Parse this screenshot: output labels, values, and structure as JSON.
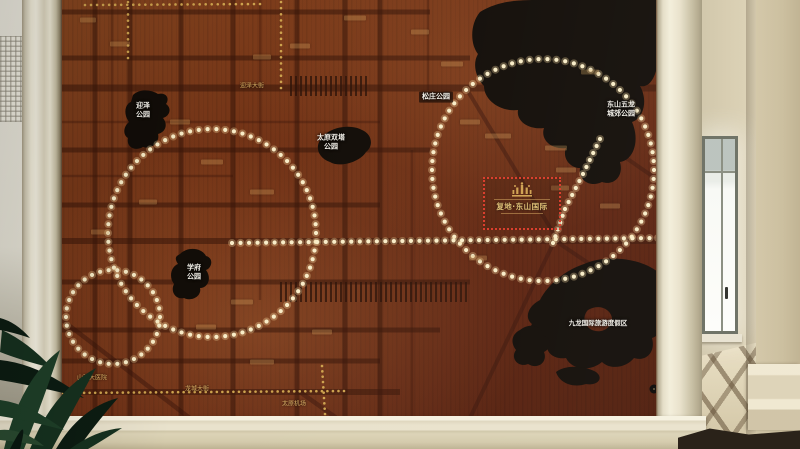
{
  "board": {
    "project_marker": {
      "label": "复地·东山国际"
    },
    "labels": [
      {
        "text": "迎泽\n公园",
        "x": 143,
        "y": 110,
        "cls": "park"
      },
      {
        "text": "太原双塔\n公园",
        "x": 331,
        "y": 142,
        "cls": "park"
      },
      {
        "text": "松庄公园",
        "x": 436,
        "y": 97,
        "cls": "park chip"
      },
      {
        "text": "东山五龙\n城郊公园",
        "x": 621,
        "y": 109,
        "cls": "park"
      },
      {
        "text": "学府\n公园",
        "x": 194,
        "y": 272,
        "cls": "park"
      },
      {
        "text": "九龙国际旅游度假区",
        "x": 598,
        "y": 323,
        "cls": "park small"
      },
      {
        "text": "迎泽大街",
        "x": 252,
        "y": 86,
        "cls": "road"
      },
      {
        "text": "龙城大街",
        "x": 197,
        "y": 389,
        "cls": "road"
      },
      {
        "text": "太原机场",
        "x": 294,
        "y": 404,
        "cls": "road"
      },
      {
        "text": "山西大医院",
        "x": 92,
        "y": 378,
        "cls": "road"
      }
    ],
    "plates": [
      [
        355,
        18,
        22
      ],
      [
        300,
        46,
        20
      ],
      [
        262,
        57,
        18
      ],
      [
        120,
        44,
        20
      ],
      [
        88,
        20,
        16
      ],
      [
        180,
        122,
        20
      ],
      [
        212,
        162,
        22
      ],
      [
        262,
        192,
        24
      ],
      [
        148,
        202,
        18
      ],
      [
        100,
        232,
        18
      ],
      [
        242,
        302,
        22
      ],
      [
        206,
        327,
        20
      ],
      [
        262,
        362,
        24
      ],
      [
        322,
        332,
        20
      ],
      [
        420,
        32,
        18
      ],
      [
        452,
        64,
        22
      ],
      [
        470,
        122,
        20
      ],
      [
        498,
        136,
        26
      ],
      [
        556,
        148,
        22
      ],
      [
        566,
        170,
        20
      ],
      [
        560,
        188,
        18
      ],
      [
        590,
        72,
        18
      ],
      [
        610,
        206,
        20
      ],
      [
        478,
        258,
        18
      ]
    ],
    "lights": {
      "led_color": "#f9edc8",
      "led_halo": "rgba(255,226,165,0.30)",
      "stud_color": "#cda34e",
      "circles": [
        {
          "cx": 212,
          "cy": 233,
          "r": 104,
          "n": 74
        },
        {
          "cx": 543,
          "cy": 170,
          "r": 111,
          "n": 78
        },
        {
          "cx": 113,
          "cy": 317,
          "r": 47,
          "n": 34
        }
      ],
      "led_lines": [
        {
          "pts": [
            [
              232,
              243
            ],
            [
              658,
              238
            ]
          ],
          "spacing": 8.6
        },
        {
          "pts": [
            [
              600,
              139
            ],
            [
              583,
              174
            ],
            [
              565,
              209
            ],
            [
              553,
              243
            ]
          ],
          "spacing": 8
        }
      ],
      "stud_lines": [
        {
          "pts": [
            [
              62,
              393
            ],
            [
              344,
              391
            ]
          ],
          "spacing": 5.5
        },
        {
          "pts": [
            [
              322,
              366
            ],
            [
              325,
              414
            ]
          ],
          "spacing": 5.5
        },
        {
          "pts": [
            [
              128,
              2
            ],
            [
              128,
              58
            ]
          ],
          "spacing": 6
        },
        {
          "pts": [
            [
              281,
              2
            ],
            [
              281,
              88
            ]
          ],
          "spacing": 6
        },
        {
          "pts": [
            [
              85,
              5
            ],
            [
              260,
              4
            ]
          ],
          "spacing": 6
        }
      ]
    },
    "colors": {
      "wood": "#6e2f14",
      "park_fill": "#120d08",
      "accent_red": "#d93a28",
      "gold": "#d8b168",
      "frame_cream": "#efe9d6"
    }
  }
}
